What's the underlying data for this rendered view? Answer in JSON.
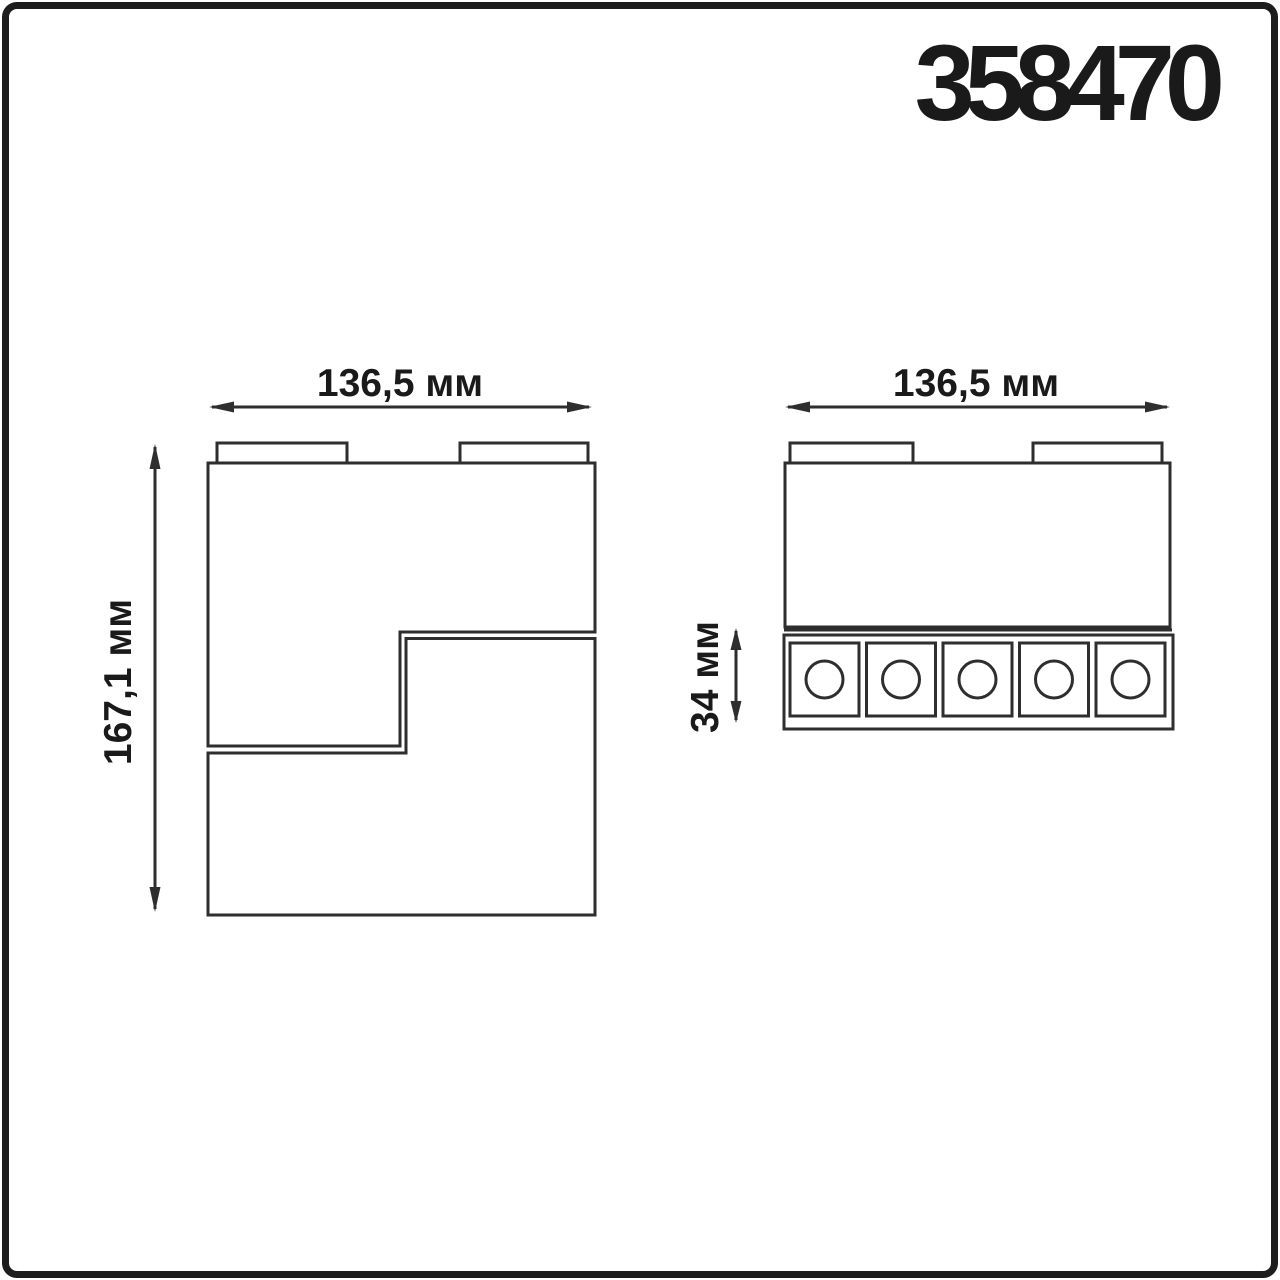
{
  "title": {
    "product_code": "358470"
  },
  "drawing": {
    "front_view": {
      "width_label": "136,5 мм",
      "height_label": "167,1 мм"
    },
    "side_view": {
      "width_label": "136,5 мм",
      "led_row_height_label": "34 мм",
      "led_count": 5
    }
  },
  "colors": {
    "background": "#ffffff",
    "frame": "#1d1d1d",
    "line": "#2e2e2e",
    "text": "#1a1a1a"
  }
}
